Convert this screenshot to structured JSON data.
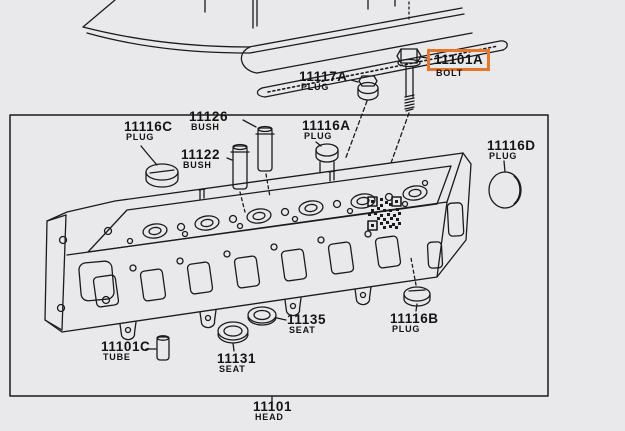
{
  "diagram": {
    "kind": "parts-diagram",
    "assembly_caption_part": "11101",
    "assembly_caption_name": "HEAD",
    "highlighted_part_number": "11101A",
    "colors": {
      "background": "#e9e9eb",
      "line_art": "#1b1b1b",
      "highlight_box": "#e6762a",
      "label_text": "#141414"
    }
  },
  "parts": [
    {
      "number": "11101A",
      "name": "BOLT",
      "highlighted": true
    },
    {
      "number": "11117A",
      "name": "PLUG",
      "highlighted": false
    },
    {
      "number": "11116C",
      "name": "PLUG",
      "highlighted": false
    },
    {
      "number": "11126",
      "name": "BUSH",
      "highlighted": false
    },
    {
      "number": "11122",
      "name": "BUSH",
      "highlighted": false
    },
    {
      "number": "11116A",
      "name": "PLUG",
      "highlighted": false
    },
    {
      "number": "11116D",
      "name": "PLUG",
      "highlighted": false
    },
    {
      "number": "11135",
      "name": "SEAT",
      "highlighted": false
    },
    {
      "number": "11116B",
      "name": "PLUG",
      "highlighted": false
    },
    {
      "number": "11101C",
      "name": "TUBE",
      "highlighted": false
    },
    {
      "number": "11131",
      "name": "SEAT",
      "highlighted": false
    },
    {
      "number": "11101",
      "name": "HEAD",
      "highlighted": false
    }
  ]
}
